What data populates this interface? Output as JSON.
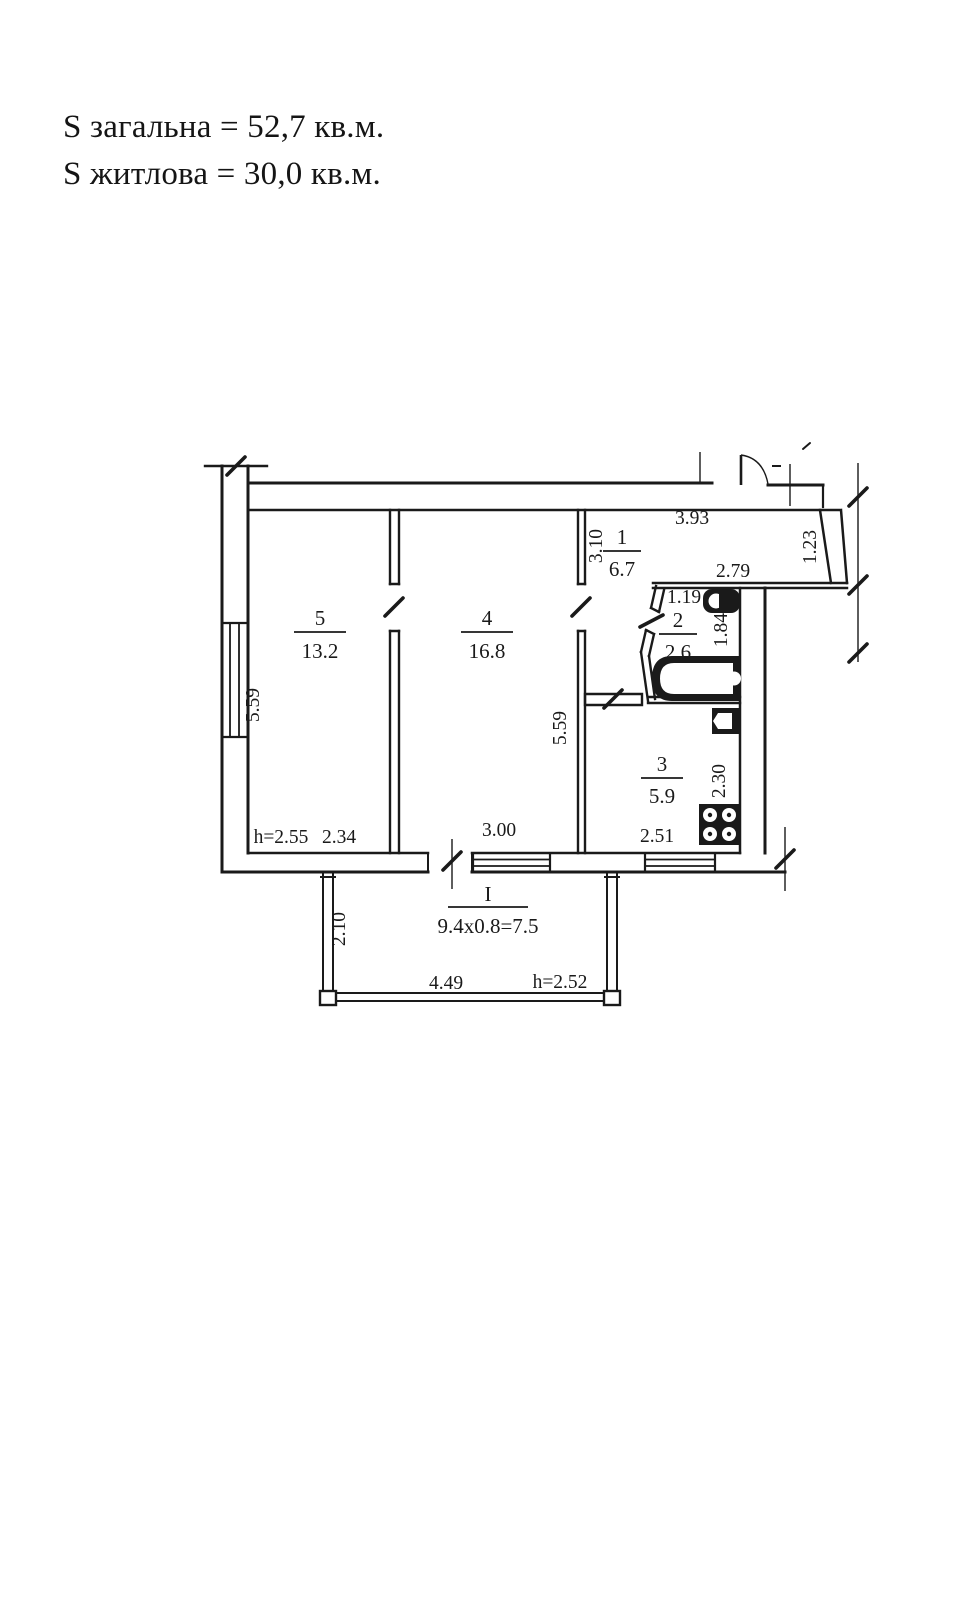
{
  "header": {
    "total_area": "S загальна = 52,7 кв.м.",
    "living_area": "S житлова = 30,0 кв.м."
  },
  "plan": {
    "rooms": [
      {
        "id": "room-5",
        "number": "5",
        "area": "13.2"
      },
      {
        "id": "room-4",
        "number": "4",
        "area": "16.8"
      },
      {
        "id": "room-1",
        "number": "1",
        "area": "6.7"
      },
      {
        "id": "room-2",
        "number": "2",
        "area": "2.6"
      },
      {
        "id": "room-3",
        "number": "3",
        "area": "5.9"
      },
      {
        "id": "balcony",
        "number": "I",
        "area": "9.4x0.8=7.5"
      }
    ],
    "dimensions": {
      "hall_width": "3.93",
      "hall_depth": "3.10",
      "bath_wall": "2.79",
      "bath_width": "1.19",
      "bath_depth": "1.84",
      "entry_side": "1.23",
      "left_wall": "5.59",
      "room4_depth": "5.59",
      "room5_height": "h=2.55",
      "room5_width": "2.34",
      "room4_width": "3.00",
      "kitchen_width": "2.51",
      "kitchen_depth": "2.30",
      "balcony_depth": "2.10",
      "balcony_width": "4.49",
      "balcony_height": "h=2.52"
    },
    "colors": {
      "line": "#1a1a1a",
      "background": "#ffffff"
    },
    "fixtures": [
      "toilet-icon",
      "bathtub-icon",
      "sink-icon",
      "stove-icon"
    ]
  }
}
